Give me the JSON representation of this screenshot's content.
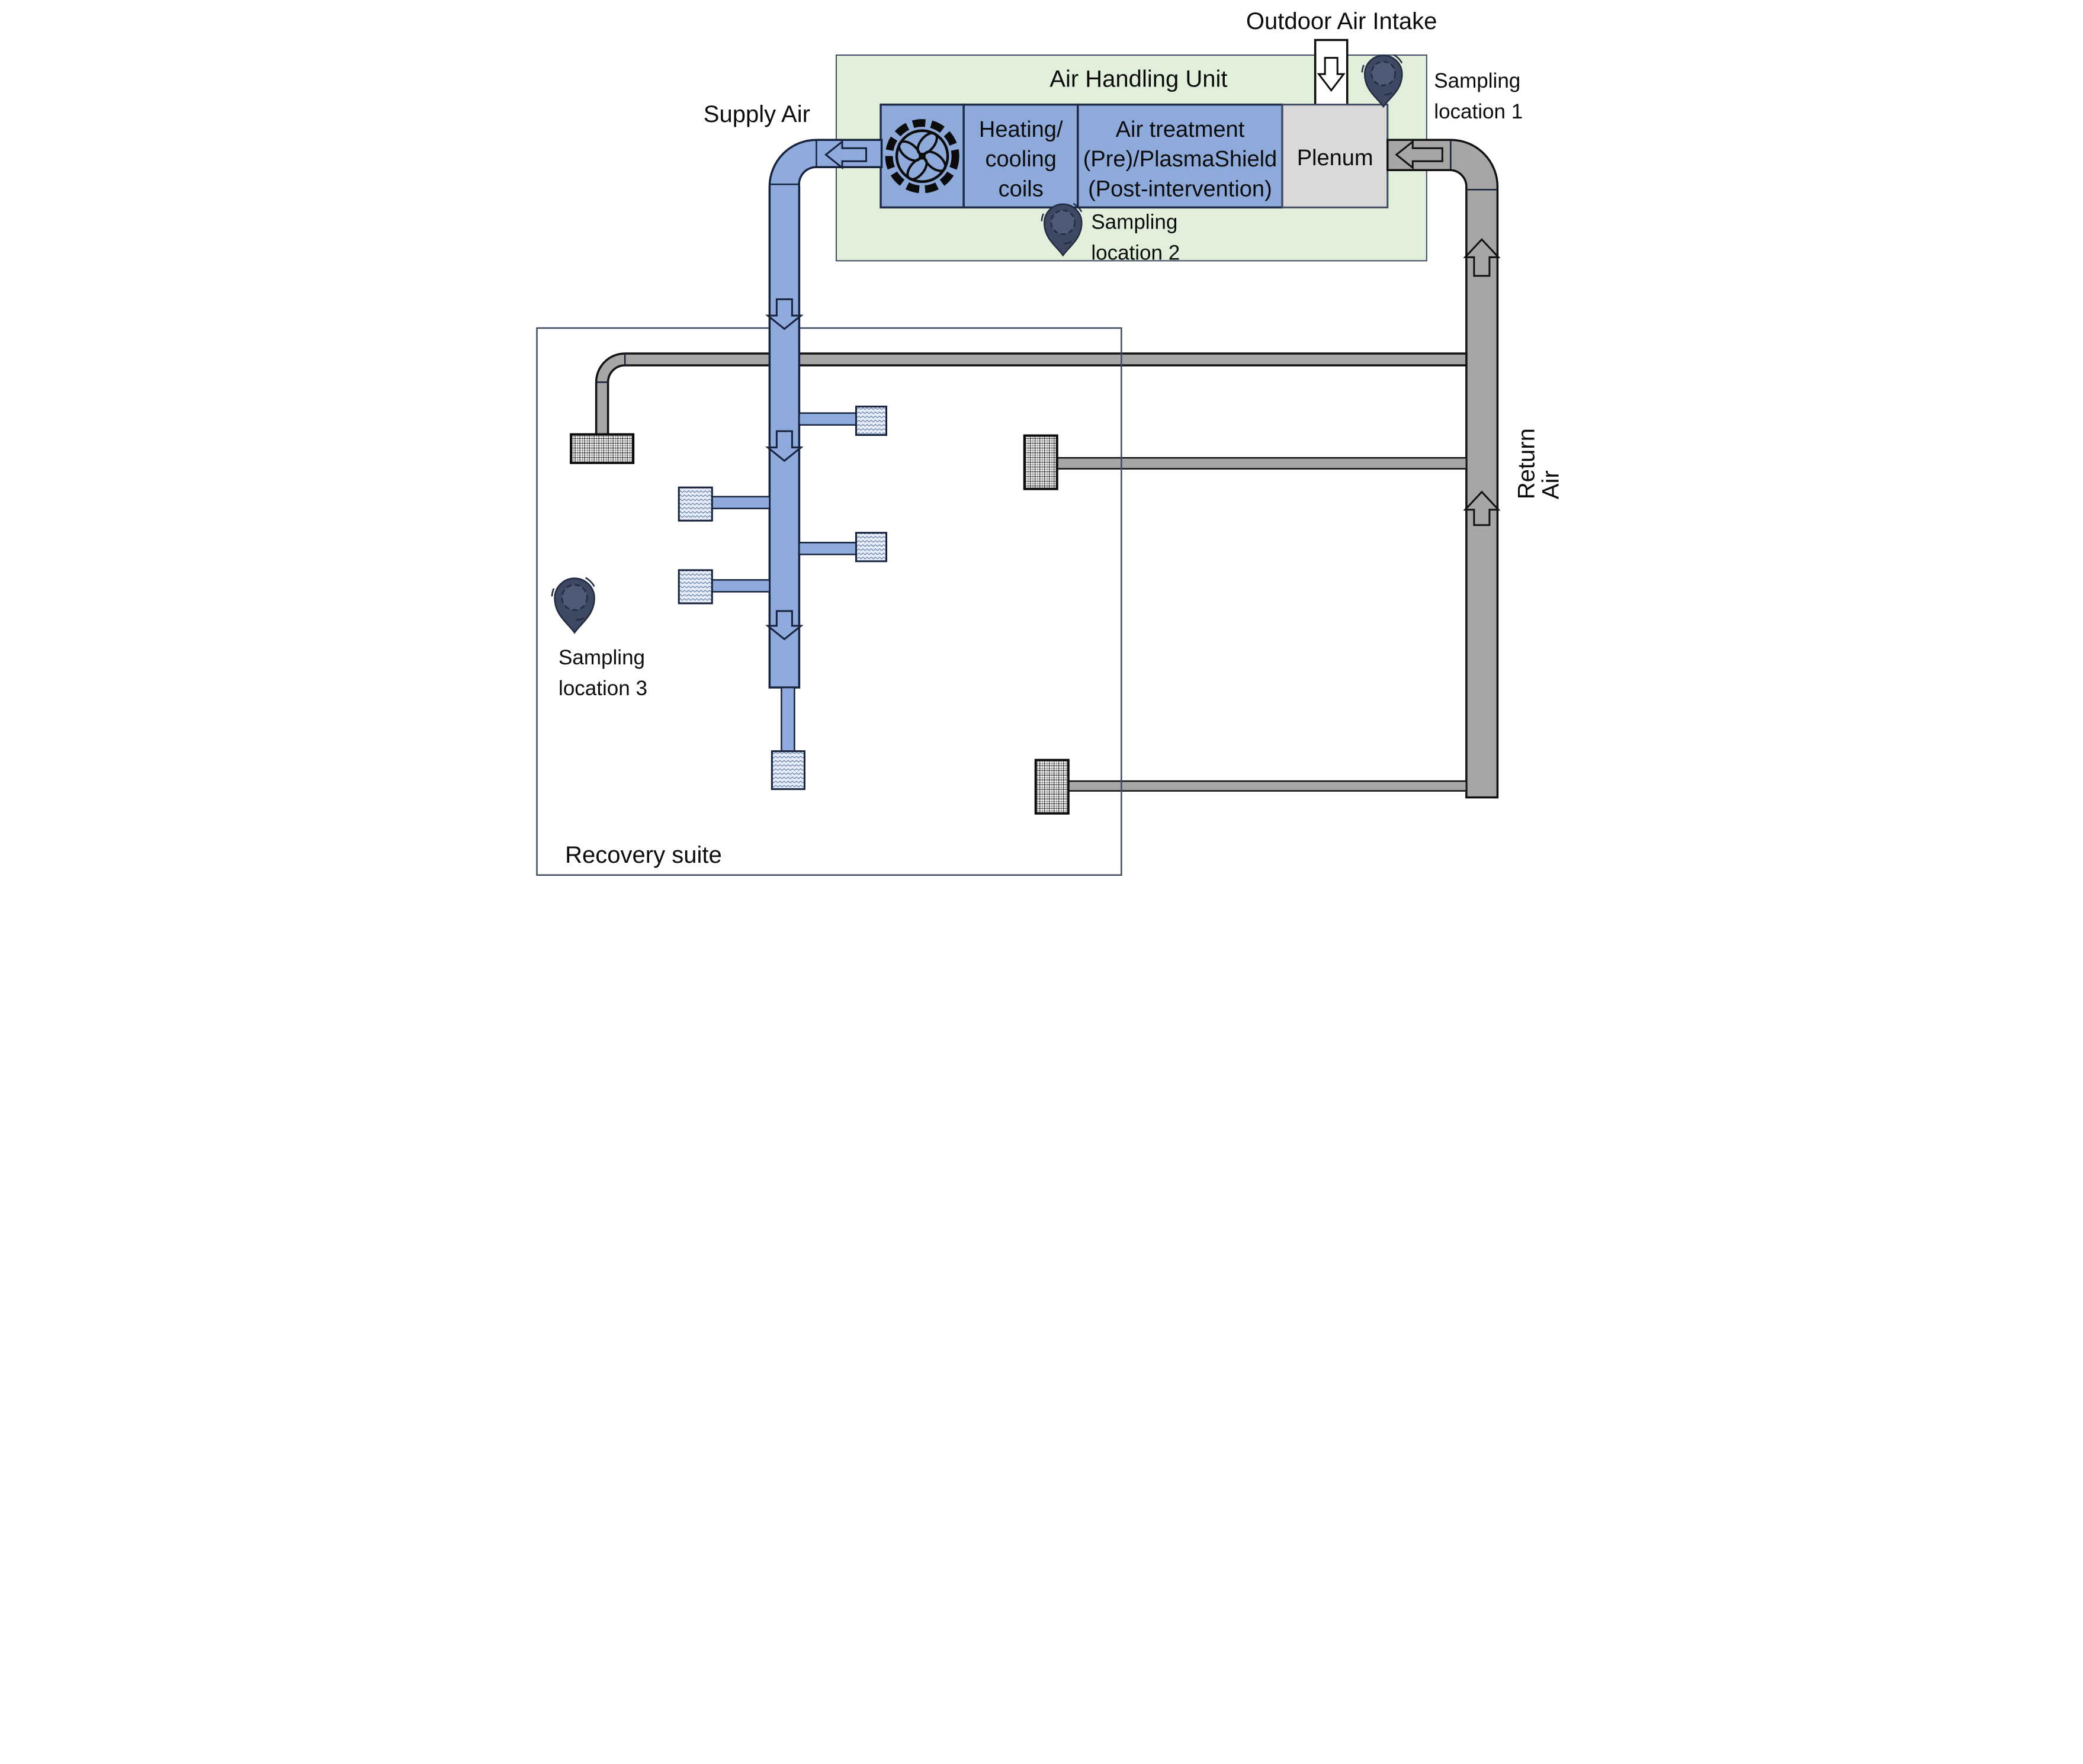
{
  "diagram_title": "HVAC air handling and sampling schematic",
  "flows": {
    "outdoor_air_intake": "Outdoor Air Intake",
    "supply_air": "Supply Air",
    "return_air_lines": [
      "Return",
      "Air"
    ]
  },
  "ahu": {
    "title": "Air Handling Unit",
    "fan_icon": "fan-icon",
    "coils_lines": [
      "Heating/",
      "cooling",
      "coils"
    ],
    "treatment_lines": [
      "Air treatment",
      "(Pre)/PlasmaShield",
      "(Post-intervention)"
    ],
    "plenum_label": "Plenum"
  },
  "zones": {
    "recovery_suite": "Recovery suite"
  },
  "sampling_locations": [
    {
      "id": 1,
      "lines": [
        "Sampling",
        "location 1"
      ]
    },
    {
      "id": 2,
      "lines": [
        "Sampling",
        "location 2"
      ]
    },
    {
      "id": 3,
      "lines": [
        "Sampling",
        "location 3"
      ]
    }
  ],
  "colors": {
    "ahu_fill": "#e2efda",
    "unit_blue": "#8eaadb",
    "supply_blue": "#8faadc",
    "return_gray": "#a6a6a6",
    "plenum_gray": "#d9d9d9",
    "outline_dark": "#17233c",
    "room_border": "#3f4a63",
    "pin_fill": "#3d4963",
    "pin_inner": "#4d5a78",
    "diffuser_fill": "#e6edf8",
    "diffuser_wave": "#4a6a9e"
  }
}
